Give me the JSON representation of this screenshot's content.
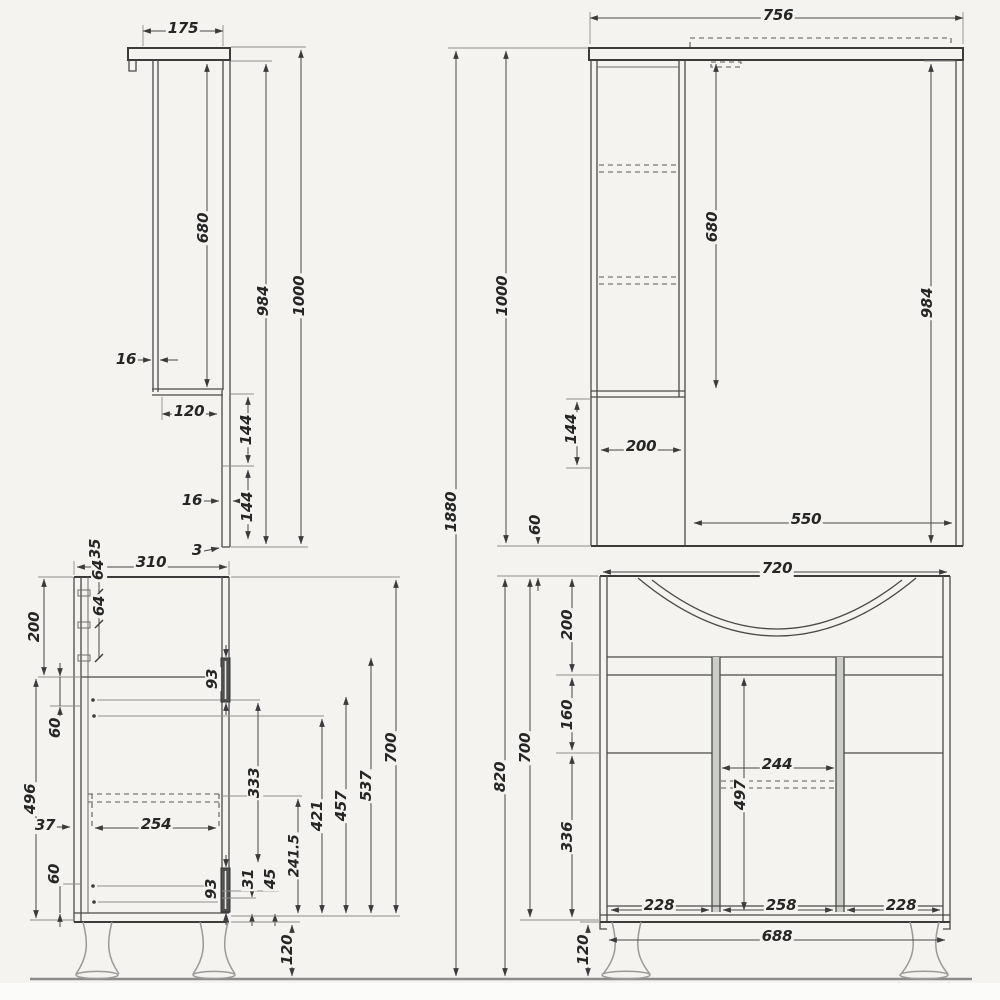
{
  "colors": {
    "background": "#f4f3f0",
    "line": "#3b3b3b",
    "light_line": "#9a9a9a"
  },
  "dims": {
    "ms": {
      "w": "175",
      "cab_h": "680",
      "mirror_h": "984",
      "total_h": "1000",
      "wall_t": "16",
      "bottom_d": "120",
      "off1": "144",
      "panel_t": "16",
      "off2": "144",
      "gap": "3"
    },
    "mf": {
      "w": "756",
      "cab_h": "680",
      "mirror_h": "984",
      "total_h": "1000",
      "below": "144",
      "cab_w": "200",
      "mirror_w": "550",
      "gap": "60"
    },
    "set": {
      "total_h": "1880"
    },
    "vs": {
      "d35": "35",
      "d64a": "64",
      "d64b": "64",
      "depth": "310",
      "top": "200",
      "g60a": "60",
      "d496": "496",
      "d37": "37",
      "d254": "254",
      "g60b": "60",
      "hinge_a": "93",
      "hinge_b": "93",
      "d31": "31",
      "d45": "45",
      "d241": "241.5",
      "d333": "333",
      "d421": "421",
      "d457": "457",
      "d537": "537",
      "h": "700",
      "legs": "120"
    },
    "vf": {
      "w": "720",
      "total_h": "820",
      "h": "700",
      "s200": "200",
      "s160": "160",
      "s336": "336",
      "mid": "244",
      "door_h": "497",
      "door_l": "228",
      "door_c": "258",
      "door_r": "228",
      "leg_span": "688",
      "legs": "120"
    }
  }
}
